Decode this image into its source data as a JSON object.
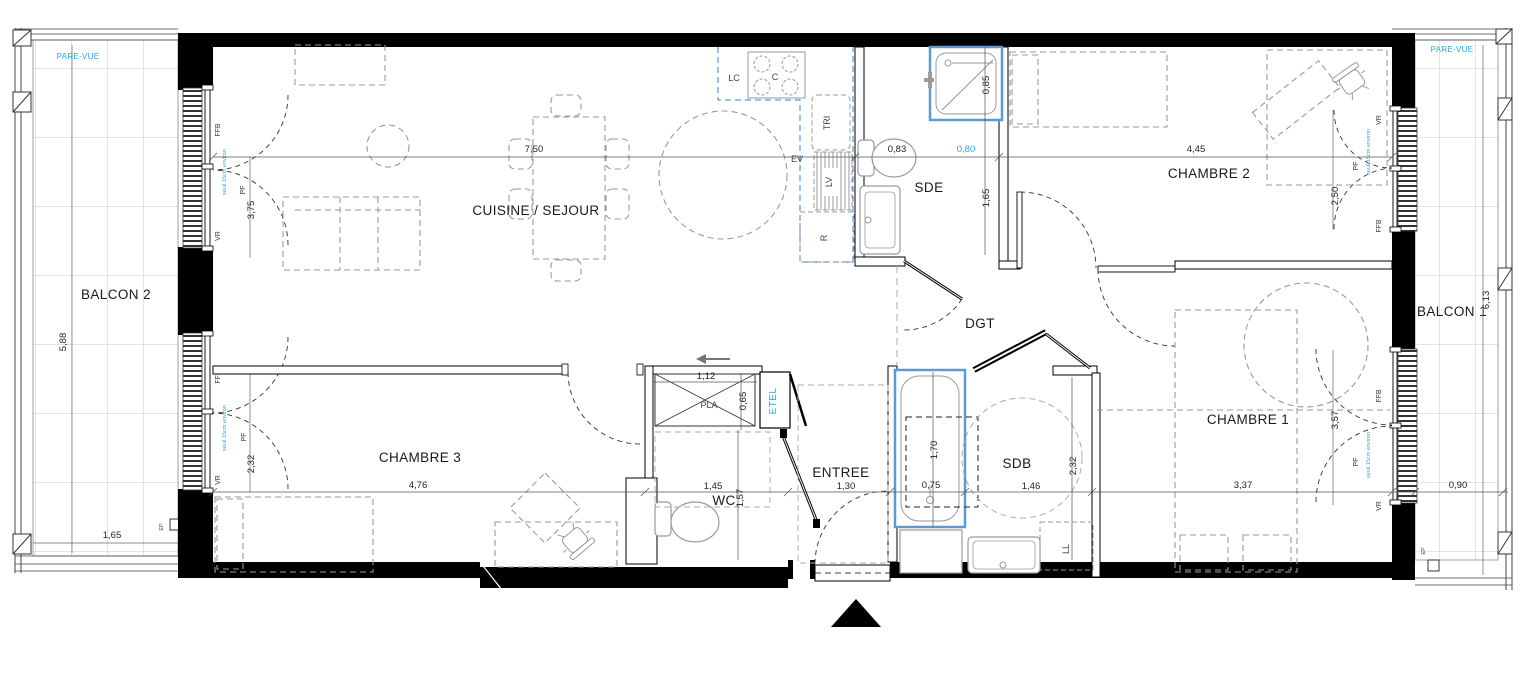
{
  "plan": {
    "rooms": {
      "balcon2": "BALCON 2",
      "balcon1": "BALCON 1",
      "cuisine_sejour": "CUISINE / SEJOUR",
      "chambre1": "CHAMBRE 1",
      "chambre2": "CHAMBRE 2",
      "chambre3": "CHAMBRE 3",
      "sde": "SDE",
      "sdb": "SDB",
      "dgt": "DGT",
      "entree": "ENTREE",
      "wc": "WC",
      "pla": "PLA",
      "etel": "ETEL"
    },
    "equipment": {
      "lc": "LC",
      "c": "C",
      "tri": "TRI",
      "ev": "EV",
      "lv": "LV",
      "r": "R",
      "ll": "LL"
    },
    "window_labels": {
      "ffb": "FFB",
      "vr": "VR",
      "pf": "PF",
      "seuil": "seuil 15cm environ",
      "pare_vue": "PARE-VUE",
      "ep": "EP"
    },
    "dimensions": {
      "sejour_width": "7,50",
      "sde_left": "0,83",
      "sde_right": "0,80",
      "chambre2_width": "4,45",
      "chambre2_depth": "2,50",
      "sejour_window": "3,75",
      "shower_width": "0,85",
      "sde_depth": "1,65",
      "balcon2_depth": "5,88",
      "balcon2_width": "1,65",
      "balcon1_length": "6,13",
      "balcon1_width": "0,90",
      "chambre3_width": "4,76",
      "chambre3_window": "2,32",
      "pla_width": "1,12",
      "pla_depth": "0,65",
      "wc_width": "1,45",
      "wc_depth": "1,57",
      "entree_width": "1,30",
      "bath_width": "0,75",
      "bath_length": "1,70",
      "sdb_width": "1,46",
      "sdb_depth": "2,32",
      "chambre1_width": "3,37",
      "chambre1_window": "3,57"
    },
    "colors": {
      "annotation_blue": "#2fa8e0",
      "fixture_blue": "#5b9bd5",
      "wall": "#000000",
      "furniture_gray": "#9a9a9a"
    }
  }
}
